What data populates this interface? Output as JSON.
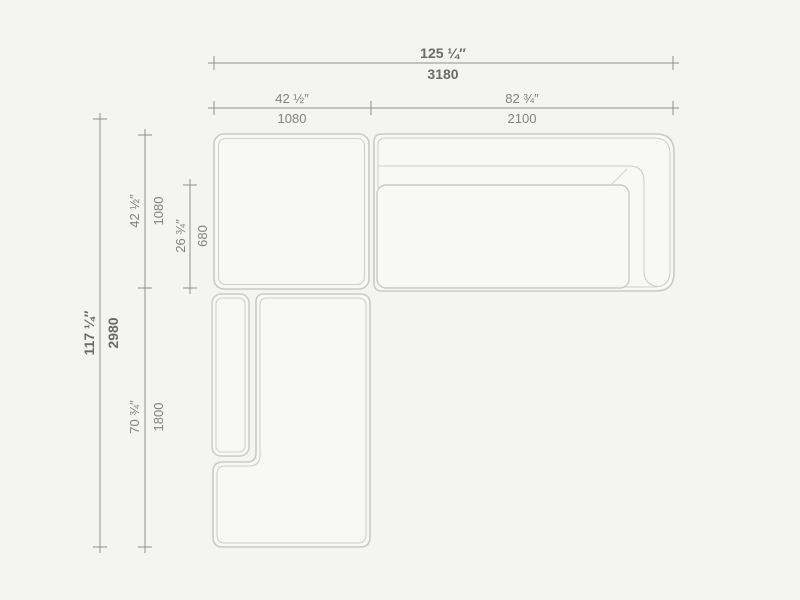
{
  "drawing": {
    "type": "sectional-sofa-top-view-dimension-drawing",
    "colors": {
      "background": "#f4f4f3",
      "sofa_fill": "#f8f8f7",
      "sofa_outline": "#c9c9c7",
      "dimension_line": "#8f8f8d",
      "dimension_text": "#82827f",
      "dimension_text_strong": "#6a6a68"
    }
  },
  "dimensions": {
    "overall_width": {
      "imperial": "125 ¼″",
      "metric": "3180"
    },
    "corner_module_width": {
      "imperial": "42 ½″",
      "metric": "1080"
    },
    "sofa_module_width": {
      "imperial": "82 ¾″",
      "metric": "2100"
    },
    "overall_depth": {
      "imperial": "117 ¼″",
      "metric": "2980"
    },
    "corner_module_depth": {
      "imperial": "42 ½″",
      "metric": "1080"
    },
    "seat_depth": {
      "imperial": "26 ¾″",
      "metric": "680"
    },
    "chaise_length": {
      "imperial": "70 ¾″",
      "metric": "1800"
    }
  }
}
